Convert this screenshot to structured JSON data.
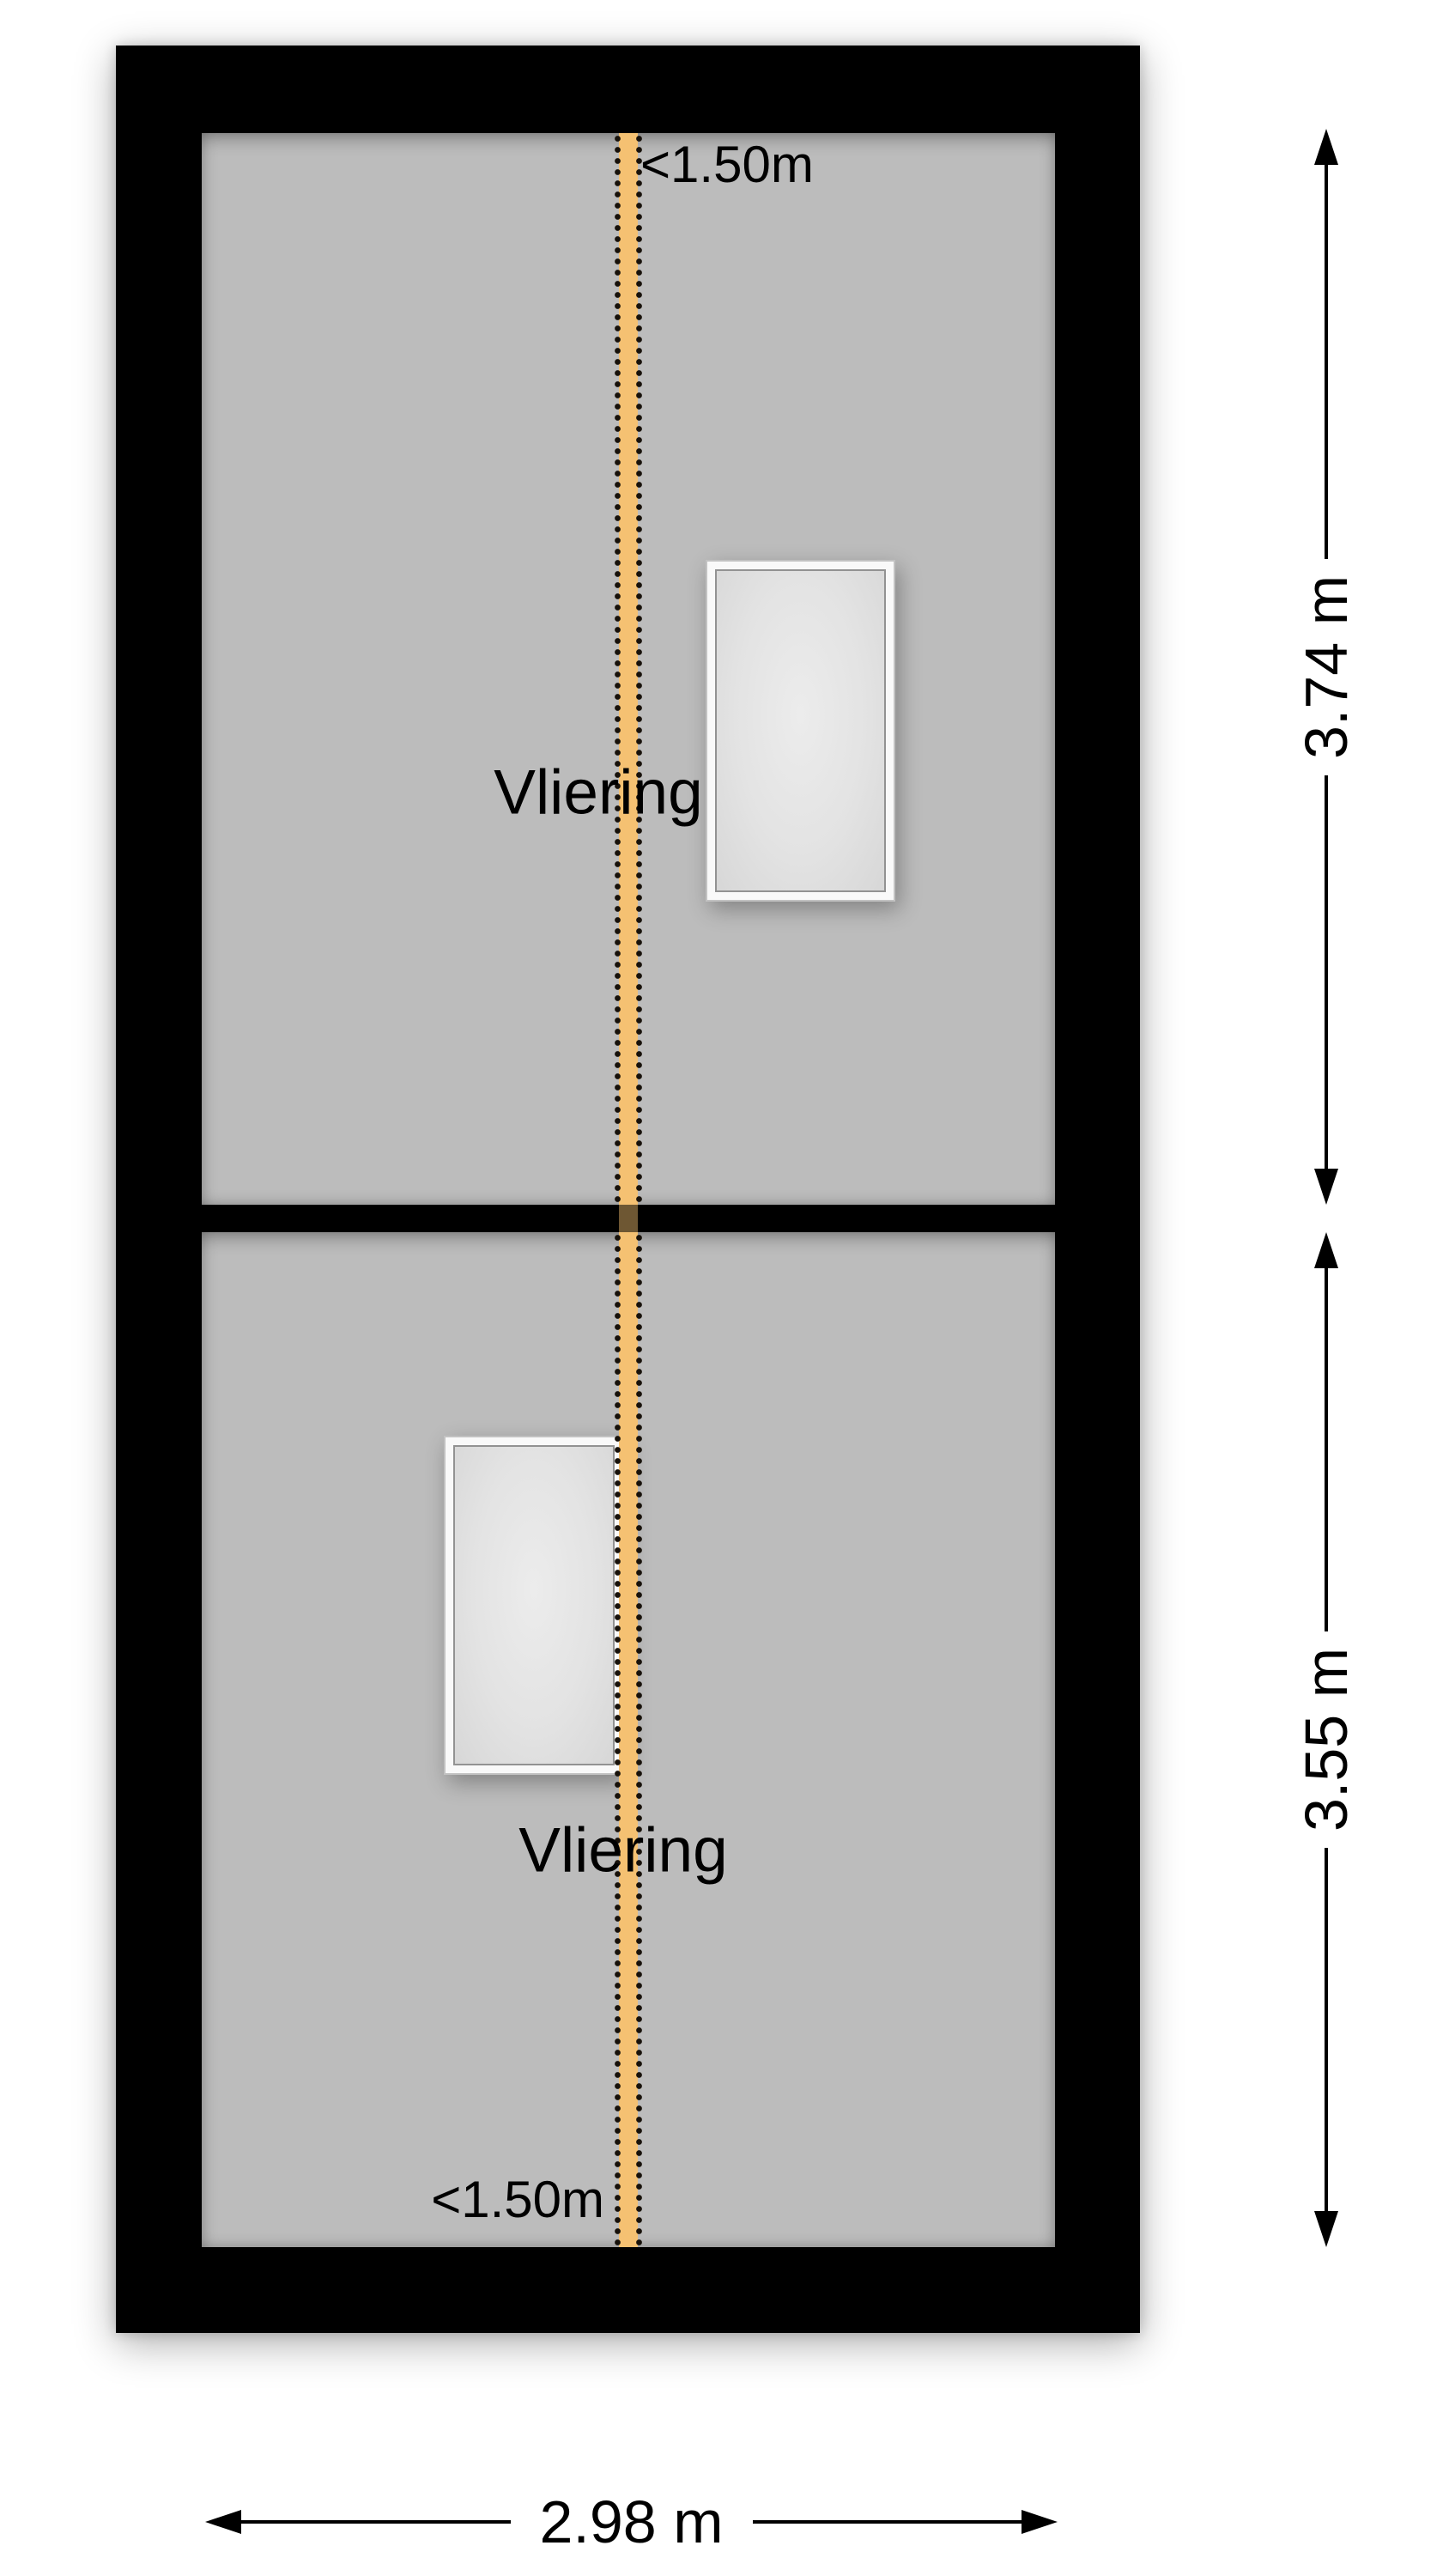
{
  "diagram": {
    "type": "floorplan-attic-level",
    "rooms": [
      {
        "label": "Vliering"
      },
      {
        "label": "Vliering"
      }
    ],
    "headroom": {
      "top_label": "<1.50m",
      "bottom_label": "<1.50m"
    },
    "dimensions": {
      "upper_room_height": "3.74 m",
      "lower_room_height": "3.55 m",
      "overall_width": "2.98 m"
    },
    "colors": {
      "wall": "#000000",
      "floor": "#bcbcbc",
      "headroom_line": "#f5c172",
      "headroom_dots": "#17110a",
      "window_glass": "#e4e4e4",
      "background": "#ffffff"
    }
  }
}
